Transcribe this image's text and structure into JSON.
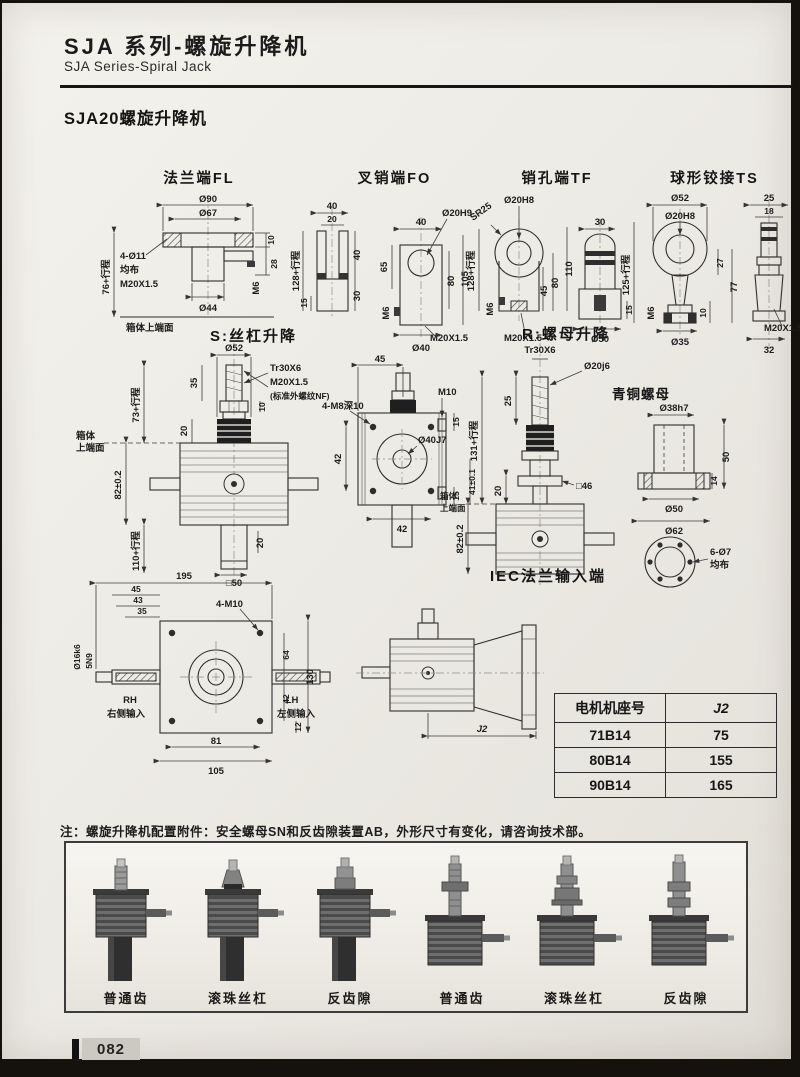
{
  "page": {
    "header_title": "SJA 系列-螺旋升降机",
    "header_subtitle": "SJA Series-Spiral Jack",
    "section_title": "SJA20螺旋升降机",
    "page_number": "082"
  },
  "drawings": {
    "fl": {
      "title": "法兰端FL",
      "d90": "Ø90",
      "d67": "Ø67",
      "t10": "10",
      "t28": "28",
      "holes": "4-Ø11",
      "evenly": "均布",
      "thread": "M20X1.5",
      "d44": "Ø44",
      "m6": "M6",
      "travel": "76+行程",
      "face": "箱体上端面"
    },
    "fo": {
      "title": "叉销端FO",
      "w40": "40",
      "w20": "20",
      "h40": "40",
      "h30": "30",
      "h15": "15",
      "travel": "128+行程",
      "w40b": "40",
      "pin": "Ø20H9",
      "h65": "65",
      "m6": "M6",
      "h80": "80",
      "h105": "105",
      "thread": "M20X1.5",
      "d40": "Ø40"
    },
    "tf": {
      "title": "销孔端TF",
      "sr": "SR25",
      "pin": "Ø20H8",
      "h110": "110",
      "h80": "80",
      "h45": "45",
      "m6": "M6",
      "thread": "M20X1.5",
      "travel": "128+行程",
      "w30": "30",
      "d50": "Ø50",
      "h15": "15"
    },
    "ts": {
      "title": "球形铰接TS",
      "d52": "Ø52",
      "pin": "Ø20H8",
      "h27": "27",
      "h77": "77",
      "h10": "10",
      "m6": "M6",
      "d35": "Ø35",
      "travel": "125+行程",
      "w25": "25",
      "w18": "18",
      "thread": "M20X1.5",
      "w32": "32"
    },
    "s": {
      "title": "S:丝杠升降",
      "d52": "Ø52",
      "tr": "Tr30X6",
      "thread": "M20X1.5",
      "thread_note": "(标准外螺纹NF)",
      "h35": "35",
      "h10": "10",
      "h20": "20",
      "travel_top": "73+行程",
      "c82": "82±0.2",
      "travel_bot": "110+行程",
      "h20b": "20",
      "sq50": "□50",
      "face1": "箱体",
      "face2": "上端面",
      "w45": "45",
      "m10": "M10",
      "h15a": "15",
      "bore": "Ø40J7",
      "v42": "42",
      "b42": "42",
      "h15b": "15",
      "c41": "41±0.1",
      "holes": "4-M8深10"
    },
    "r": {
      "title": "R:螺母升降",
      "tr": "Tr30X6",
      "d20": "Ø20j6",
      "h25": "25",
      "h20": "20",
      "sq46": "□46",
      "travel": "131+行程",
      "c82": "82±0.2",
      "face1": "箱体",
      "face2": "上端面"
    },
    "nut": {
      "title": "青铜螺母",
      "d38": "Ø38h7",
      "h50": "50",
      "h14": "14",
      "d50": "Ø50",
      "d62": "Ø62",
      "holes": "6-Ø7",
      "evenly": "均布"
    },
    "tv": {
      "w195": "195",
      "w45": "45",
      "w43": "43",
      "w35": "35",
      "shaft": "Ø16k6",
      "key": "5N9",
      "holes": "4-M10",
      "rh": "RH",
      "rh_label": "右侧输入",
      "lh": "LH",
      "lh_label": "左侧输入",
      "h64": "64",
      "h130": "130",
      "h42": "42",
      "h12": "12",
      "w81": "81",
      "w105": "105"
    },
    "iec": {
      "title": "IEC法兰输入端",
      "j2": "J2"
    }
  },
  "motor_table": {
    "headers": [
      "电机机座号",
      "J2"
    ],
    "rows": [
      [
        "71B14",
        "75"
      ],
      [
        "80B14",
        "155"
      ],
      [
        "90B14",
        "165"
      ]
    ]
  },
  "note": "注：螺旋升降机配置附件：安全螺母SN和反齿隙装置AB，外形尺寸有变化，请咨询技术部。",
  "products": [
    {
      "label": "普通齿"
    },
    {
      "label": "滚珠丝杠"
    },
    {
      "label": "反齿隙"
    },
    {
      "label": "普通齿"
    },
    {
      "label": "滚珠丝杠"
    },
    {
      "label": "反齿隙"
    }
  ]
}
